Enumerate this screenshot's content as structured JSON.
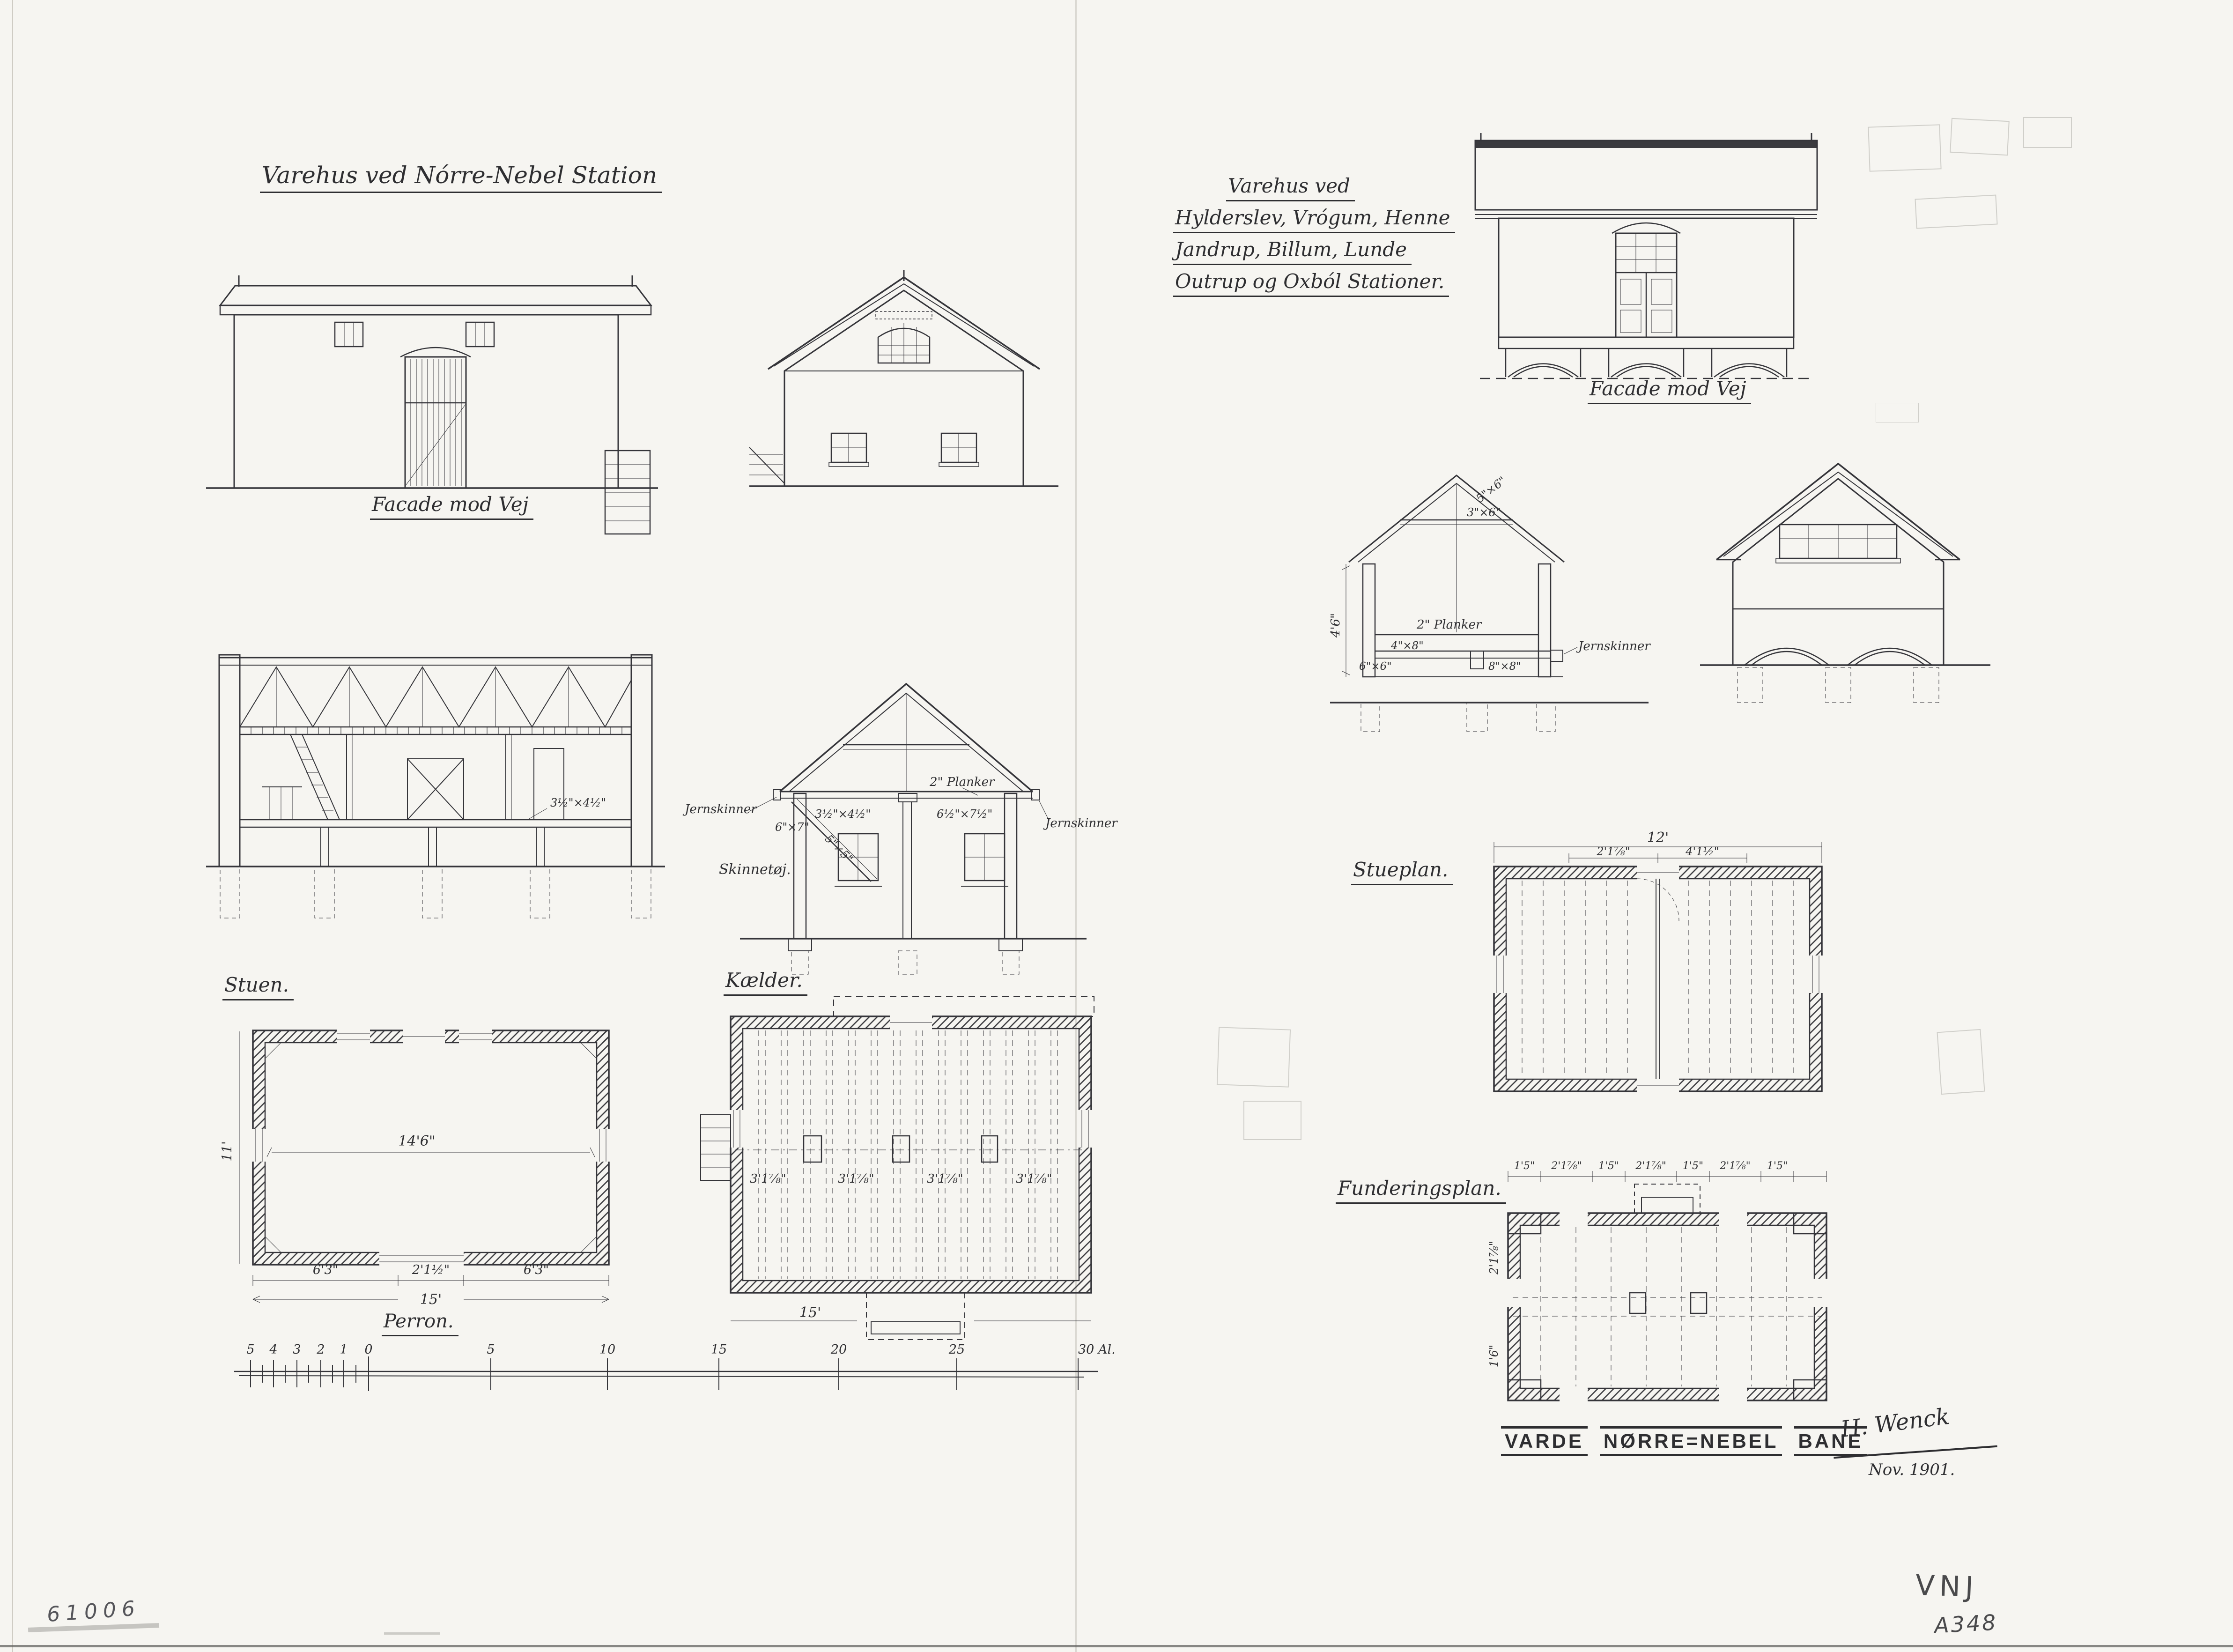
{
  "sheet": {
    "left_title": "Varehus ved Nórre-Nebel Station",
    "right_title": {
      "l1": "Varehus ved",
      "l2": "Hylderslev, Vrógum, Henne",
      "l3": "Jandrup, Billum, Lunde",
      "l4": "Outrup og Oxból Stationer."
    },
    "stamp": {
      "w1": "VARDE",
      "w2": "NØRRE=NEBEL",
      "w3": "BANE"
    },
    "signature": "H. Wenck",
    "date": "Nov. 1901.",
    "inventory_no": "61006",
    "mark_line1": "VNJ",
    "mark_line2": "A348"
  },
  "captions": {
    "facade_left": "Facade mod Vej",
    "facade_right": "Facade mod Vej",
    "stuen": "Stuen.",
    "kaelder": "Kælder.",
    "stueplan": "Stueplan.",
    "funderingsplan": "Funderingsplan.",
    "perron": "Perron."
  },
  "dims_left": {
    "interior": "14'6\"",
    "height": "11'",
    "b1": "6'3\"",
    "b2": "2'1½\"",
    "b3": "6'3\"",
    "total": "15'",
    "kaelder_total": "15'",
    "bays": [
      "3'1⅞\"",
      "3'1⅞\"",
      "3'1⅞\"",
      "3'1⅞\""
    ],
    "sec_dim": "3½\"×4½\""
  },
  "labels_left_section": {
    "jern_left": "Jernskinner",
    "jern_right": "Jernskinner",
    "planker": "2\" Planker",
    "skinnet": "Skinnetøj.",
    "d67": "6\"×7\"",
    "d55": "5\"×5\"",
    "d3445": "3½\"×4½\"",
    "d6575": "6½\"×7½\""
  },
  "labels_right_section": {
    "planker": "2\" Planker",
    "jern": "Jernskinner",
    "d48": "4\"×8\"",
    "d66": "6\"×6\"",
    "d88": "8\"×8\"",
    "d56": "5\"×6\"",
    "d36": "3\"×6\"",
    "wall_height": "4'6\""
  },
  "dims_right": {
    "stueplan_total": "12'",
    "s1": "2'1⅞\"",
    "s2": "4'1½\"",
    "fund_row": [
      "1'5\"",
      "2'1⅞\"",
      "1'5\"",
      "2'1⅞\"",
      "1'5\"",
      "2'1⅞\"",
      "1'5\""
    ],
    "f_left1": "2'1⅞\"",
    "f_left2": "1'6\""
  },
  "scale": {
    "labels": [
      "5",
      "4",
      "3",
      "2",
      "1",
      "0",
      "5",
      "10",
      "15",
      "20",
      "25",
      "30 Al."
    ]
  },
  "colors": {
    "ink": "#35353a",
    "pencil": "#8a8a86",
    "paper": "#f6f5f1"
  }
}
